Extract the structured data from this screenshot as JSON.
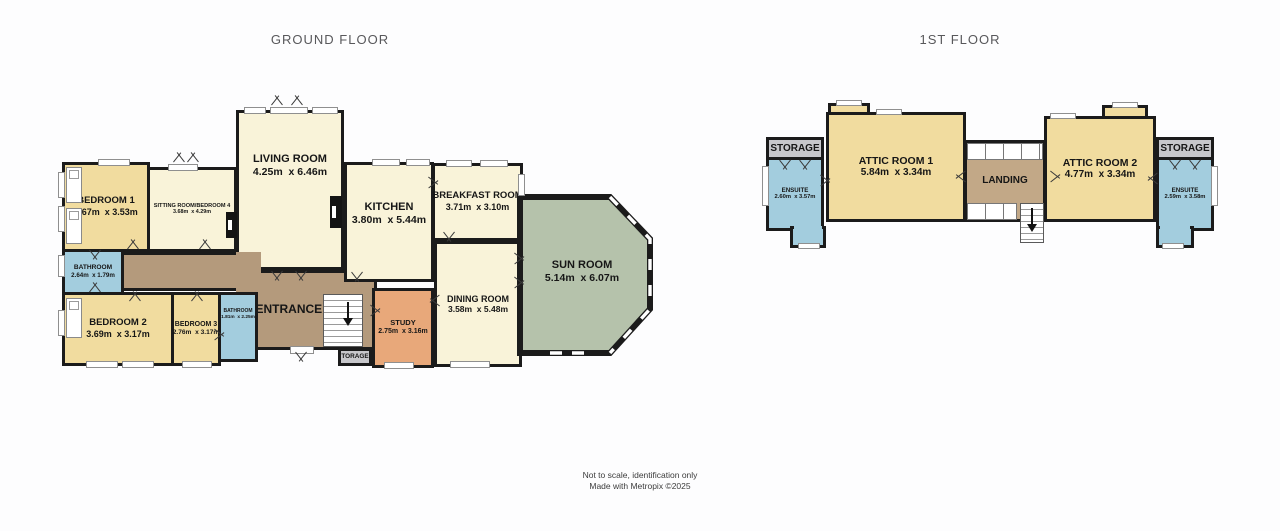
{
  "colors": {
    "bg": "#fdfdfe",
    "wall": "#1b1b1b",
    "cream": "#f9f3d9",
    "yellow": "#f1dc9f",
    "blue": "#a3cdde",
    "hall": "#b49a7c",
    "landing": "#c2a887",
    "study": "#e8a87a",
    "sun": "#b5c2ab",
    "storage": "#c7c7cb"
  },
  "titles": {
    "ground": "GROUND FLOOR",
    "first": "1ST FLOOR"
  },
  "footer": {
    "line1": "Not to scale, identification only",
    "line2": "Made with Metropix ©2025"
  },
  "ground": {
    "bedroom1": {
      "name": "BEDROOM 1",
      "dims": "3.67m  x 3.53m"
    },
    "sitting": {
      "name": "SITTING ROOM/BEDROOM 4",
      "dims": "3.68m  x 4.29m"
    },
    "living": {
      "name": "LIVING ROOM",
      "dims": "4.25m  x 6.46m"
    },
    "kitchen": {
      "name": "KITCHEN",
      "dims": "3.80m  x 5.44m"
    },
    "breakfast": {
      "name": "BREAKFAST ROOM",
      "dims": "3.71m  x 3.10m"
    },
    "sunroom": {
      "name": "SUN ROOM",
      "dims": "5.14m  x 6.07m"
    },
    "dining": {
      "name": "DINING ROOM",
      "dims": "3.58m  x 5.48m"
    },
    "study": {
      "name": "STUDY",
      "dims": "2.75m  x 3.16m"
    },
    "entrance": {
      "name": "ENTRANCE HALL"
    },
    "bathroom1": {
      "name": "BATHROOM",
      "dims": "2.64m  x 1.79m"
    },
    "bathroom2": {
      "name": "BATHROOM",
      "dims": "1.81m  x 2.25m"
    },
    "bedroom2": {
      "name": "BEDROOM 2",
      "dims": "3.69m  x 3.17m"
    },
    "bedroom3": {
      "name": "BEDROOM 3",
      "dims": "2.76m  x 3.17m"
    },
    "storage": {
      "name": "TORAGE"
    }
  },
  "first": {
    "storage_left": {
      "name": "STORAGE"
    },
    "ensuite_left": {
      "name": "ENSUITE",
      "dims": "2.60m  x 3.57m"
    },
    "attic1": {
      "name": "ATTIC ROOM 1",
      "dims": "5.84m  x 3.34m"
    },
    "landing": {
      "name": "LANDING"
    },
    "attic2": {
      "name": "ATTIC ROOM 2",
      "dims": "4.77m  x 3.34m"
    },
    "ensuite_right": {
      "name": "ENSUITE",
      "dims": "2.59m  x 3.58m"
    },
    "storage_right": {
      "name": "STORAGE"
    }
  }
}
